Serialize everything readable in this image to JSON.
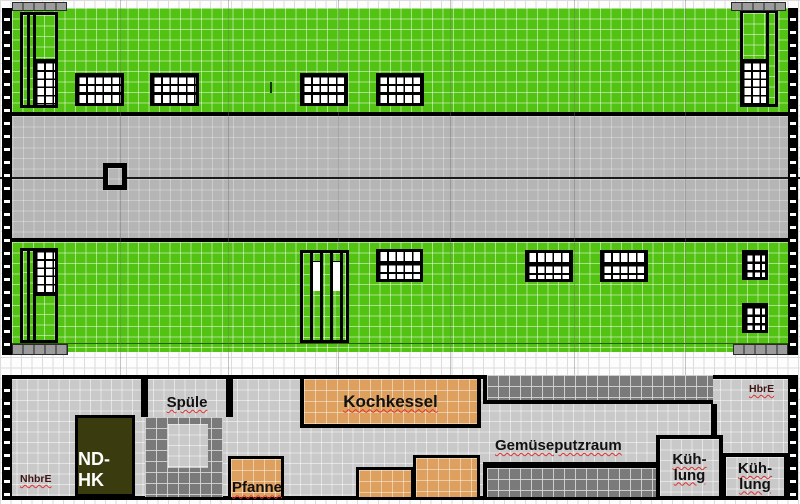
{
  "plan": {
    "rooms": {
      "spuele": "Spüle",
      "kochkessel": "Kochkessel",
      "gemueseputzraum": "Gemüseputzraum",
      "kuehlung_left": "Küh-\nlung",
      "kuehlung_right": "Küh-\nlung",
      "ndhk": "ND-HK",
      "pfanne": "Pfanne"
    },
    "annotations": {
      "nhbre": "NhbrE",
      "hbre": "HbrE"
    }
  },
  "colors": {
    "grass_green": "#52c313",
    "road_gray": "#b5b5b5",
    "floor_gray": "#c9c9c9",
    "counter_dark_gray": "#7a7a7a",
    "equipment_orange": "#dda05f",
    "ndhk_olive": "#3b3b10",
    "wall_black": "#000000",
    "spellcheck_red": "#e03030",
    "sidewalk_gray": "#9c9c9c"
  }
}
